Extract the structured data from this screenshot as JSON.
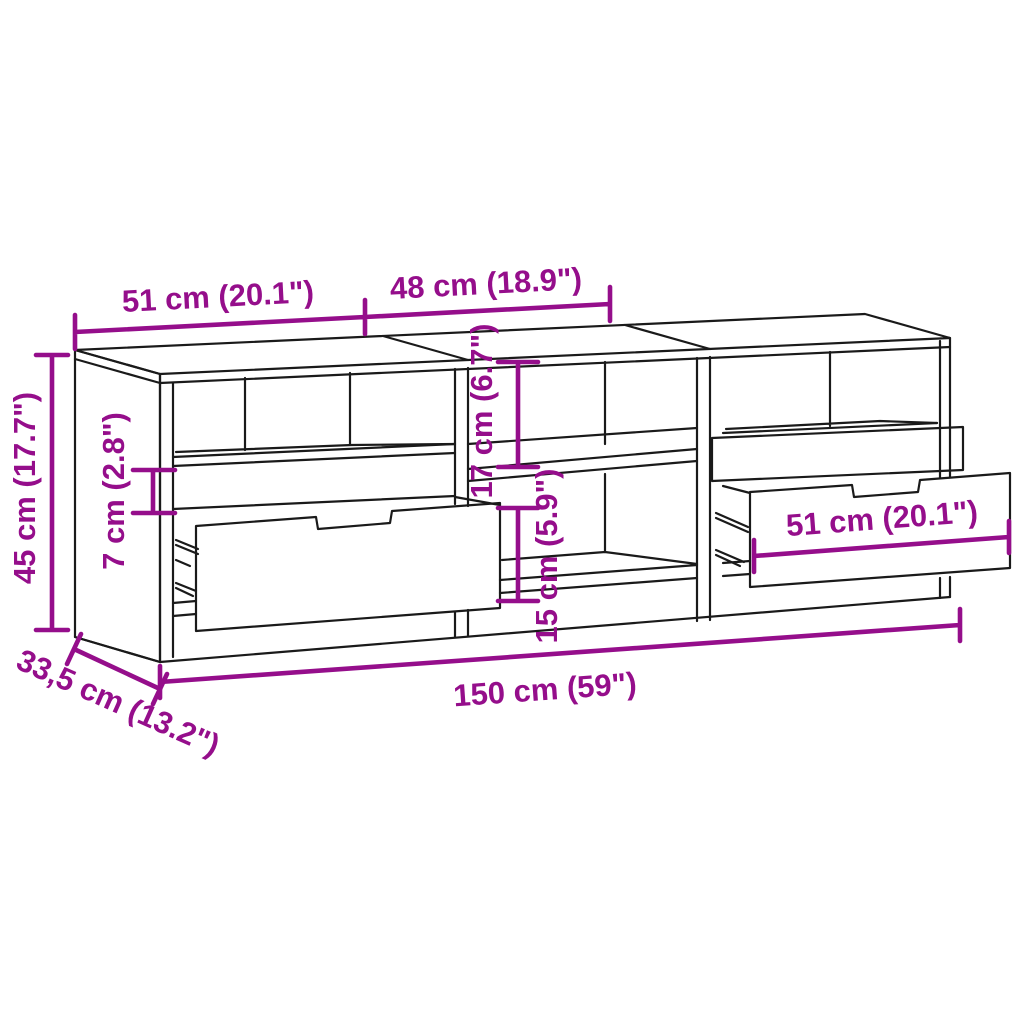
{
  "diagram": {
    "type": "furniture-dimension-diagram",
    "subject": "TV cabinet with three sections, open shelves and pull-out drawers",
    "style": {
      "line_color": "#1a1a1a",
      "dimension_color": "#950E8B",
      "background_color": "#ffffff"
    },
    "labels": {
      "width_left_section": "51 cm (20.1\")",
      "width_middle_section": "48 cm (18.9\")",
      "height_total": "45 cm (17.7\")",
      "height_drawer_front": "7 cm (2.8\")",
      "height_upper_compartment": "17 cm (6.7\")",
      "height_lower_compartment": "15 cm (5.9\")",
      "width_drawer": "51 cm (20.1\")",
      "width_total": "150 cm (59\")",
      "depth_total": "33,5 cm (13.2\")"
    }
  }
}
